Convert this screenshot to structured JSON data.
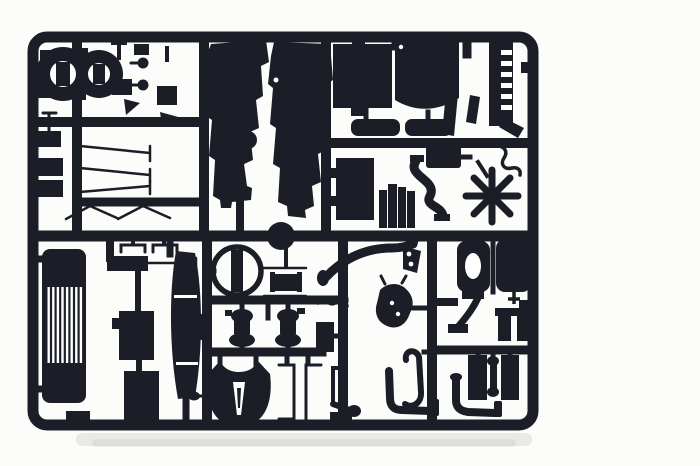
{
  "meta": {
    "subject": "Photograph of a black injection-molded model kit sprue with truck model parts",
    "width": 700,
    "height": 466
  },
  "colors": {
    "background": "#fcfcfb",
    "plastic": "#1b1e27",
    "white_detail": "#ffffff",
    "shadow": "#a8a8a4"
  },
  "sprue": {
    "frame": "rounded rectangular runner frame with internal cross runners",
    "parts": [
      "air-cleaner-half-left",
      "air-cleaner-half-right",
      "mounting-pins",
      "small-blocks",
      "cab-shell-left-half",
      "cab-shell-right-half",
      "pedal-assembly",
      "radiator-core",
      "radiator-shell",
      "silencer-left",
      "silencer-right",
      "radiator-bracket",
      "engine-block",
      "cylinder-battery",
      "intake-s-pipe",
      "intercooler",
      "exhaust-heat-shield",
      "support-strip",
      "wiring-squiggle",
      "cooling-fan",
      "front-grille",
      "channel-staples",
      "storage-box-rod",
      "battery-box",
      "tool-box",
      "leaf-spring-blade",
      "steering-wheel",
      "filler-cap",
      "front-axle",
      "turbocharger-left",
      "turbocharger-right",
      "fifth-wheel-plate",
      "frame-bracket-left",
      "frame-bracket-right",
      "winding-crank",
      "exhaust-s-pipe",
      "cab-step-bracket",
      "engine-mount",
      "towing-hook",
      "air-tank-ported",
      "air-tank-plain",
      "tank-strap",
      "mounting-brackets",
      "rear-lamp-housings",
      "axle-spool",
      "exhaust-elbow-left",
      "exhaust-elbow-right",
      "wiper-arms",
      "mudflap-brackets"
    ]
  }
}
